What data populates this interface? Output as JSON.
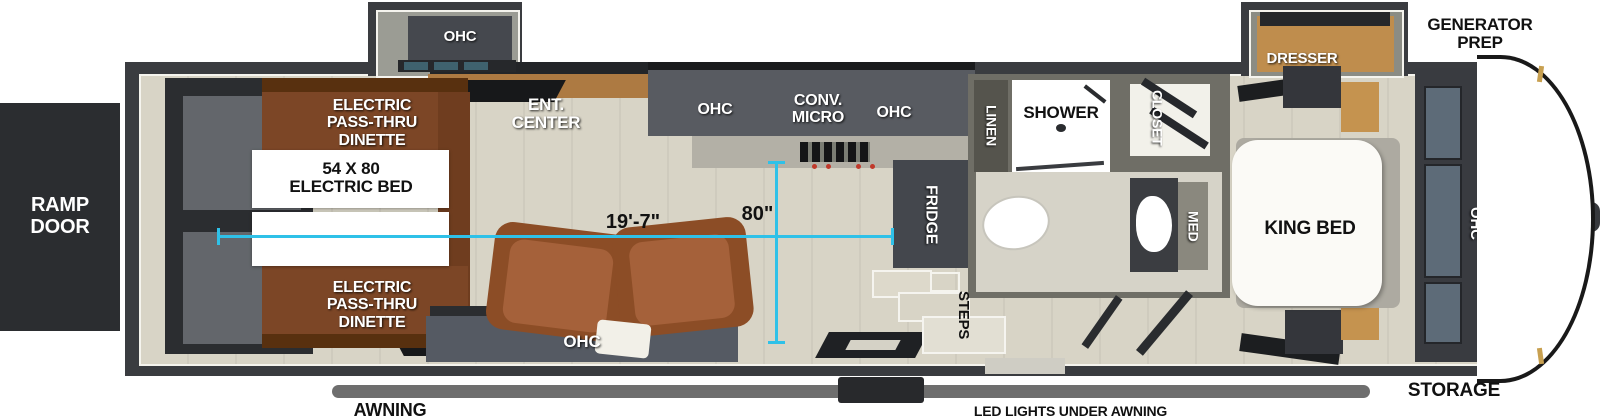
{
  "exterior": {
    "ramp_door": "RAMP\nDOOR",
    "generator_prep": "GENERATOR\nPREP",
    "storage": "STORAGE",
    "awning": "AWNING",
    "led_lights": "LED LIGHTS UNDER AWNING"
  },
  "garage": {
    "dinette_top": "ELECTRIC\nPASS-THRU\nDINETTE",
    "dinette_bottom": "ELECTRIC\nPASS-THRU\nDINETTE",
    "electric_bed": "54 X 80\nELECTRIC BED"
  },
  "living": {
    "ohc_slide": "OHC",
    "ent_center": "ENT.\nCENTER",
    "ohc_sofa": "OHC"
  },
  "kitchen": {
    "ohc_left": "OHC",
    "conv_micro": "CONV.\nMICRO",
    "ohc_right": "OHC",
    "fridge": "FRIDGE"
  },
  "bath": {
    "linen": "LINEN",
    "shower": "SHOWER",
    "closet": "CLOSET",
    "med": "MED",
    "steps": "STEPS"
  },
  "bedroom": {
    "dresser": "DRESSER",
    "king_bed": "KING BED",
    "ohc": "OHC"
  },
  "dimensions": {
    "length": "19'-7\"",
    "width": "80\""
  },
  "colors": {
    "accent_cyan": "#2fc1e8",
    "wall_dark": "#3a3c40",
    "floor_beige": "#d8d4c6",
    "cabinet_gray": "#565960",
    "wood_brown": "#7c4626",
    "recliner_brown": "#a5613a",
    "dresser_tan": "#c08d4d",
    "awning_gray": "#6e6e6e"
  }
}
